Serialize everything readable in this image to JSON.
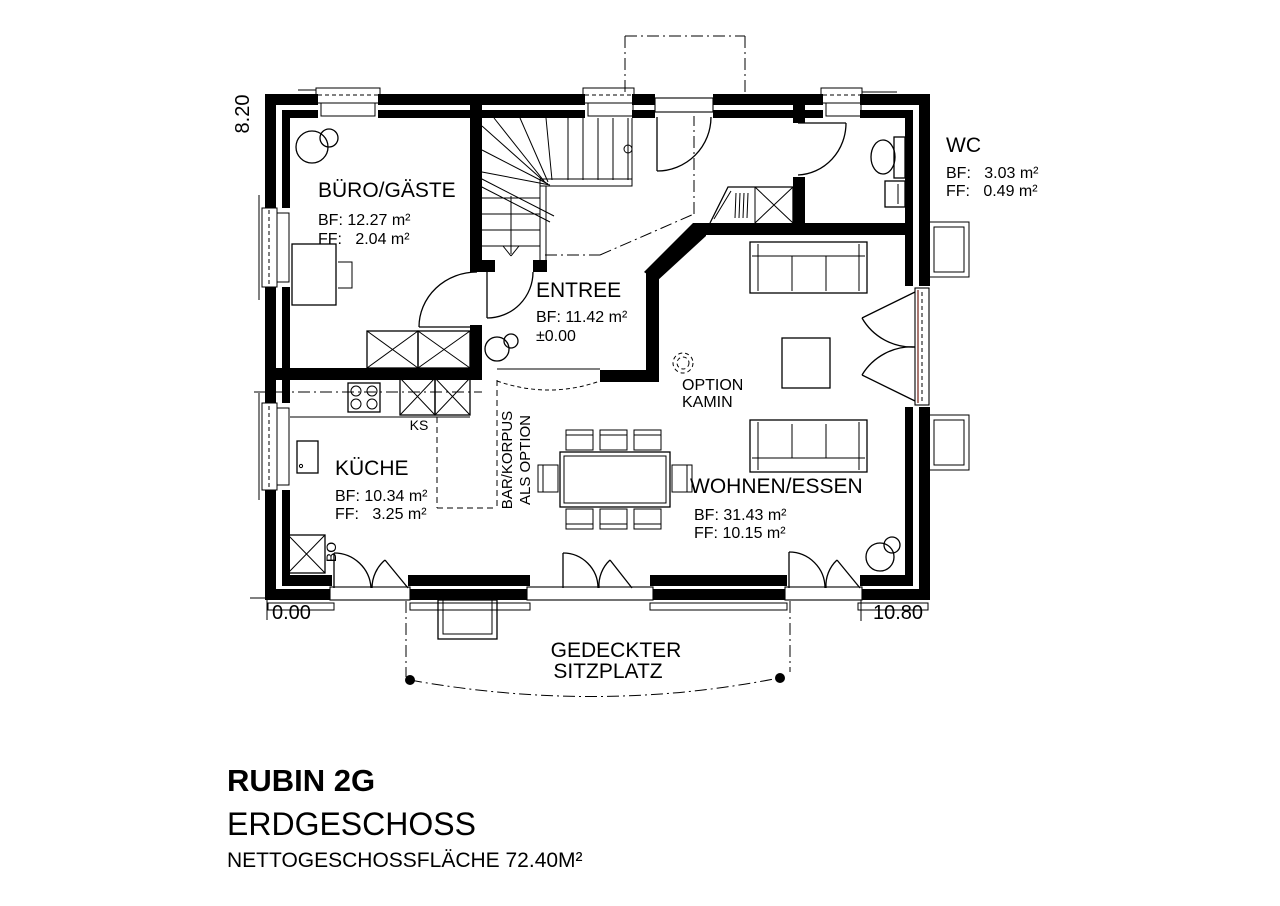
{
  "title_block": {
    "model": "RUBIN 2G",
    "floor": "ERDGESCHOSS",
    "area_note": "NETTOGESCHOSSFLÄCHE 72.40M²"
  },
  "dimensions": {
    "left_height": "8.20",
    "origin": "0.00",
    "width": "10.80"
  },
  "rooms": {
    "buero": {
      "name": "BÜRO/GÄSTE",
      "bf": "BF: 12.27 m²",
      "ff": "FF:   2.04 m²"
    },
    "entree": {
      "name": "ENTREE",
      "bf": "BF: 11.42 m²",
      "level": "±0.00"
    },
    "wc": {
      "name": "WC",
      "bf": "BF:   3.03 m²",
      "ff": "FF:   0.49 m²"
    },
    "kueche": {
      "name": "KÜCHE",
      "bf": "BF: 10.34 m²",
      "ff": "FF:   3.25 m²"
    },
    "wohnen": {
      "name": "WOHNEN/ESSEN",
      "bf": "BF: 31.43 m²",
      "ff": "FF: 10.15 m²"
    }
  },
  "annotations": {
    "fireplace_option": [
      "OPTION",
      "KAMIN"
    ],
    "bar_option": [
      "BAR/KORPUS",
      "ALS OPTION"
    ],
    "fridge": "KS",
    "oven": "BO",
    "covered_seat": [
      "GEDECKTER",
      "SITZPLATZ"
    ]
  },
  "colors": {
    "ink": "#000000",
    "paper": "#ffffff",
    "door_accent": "#8d4a42"
  }
}
